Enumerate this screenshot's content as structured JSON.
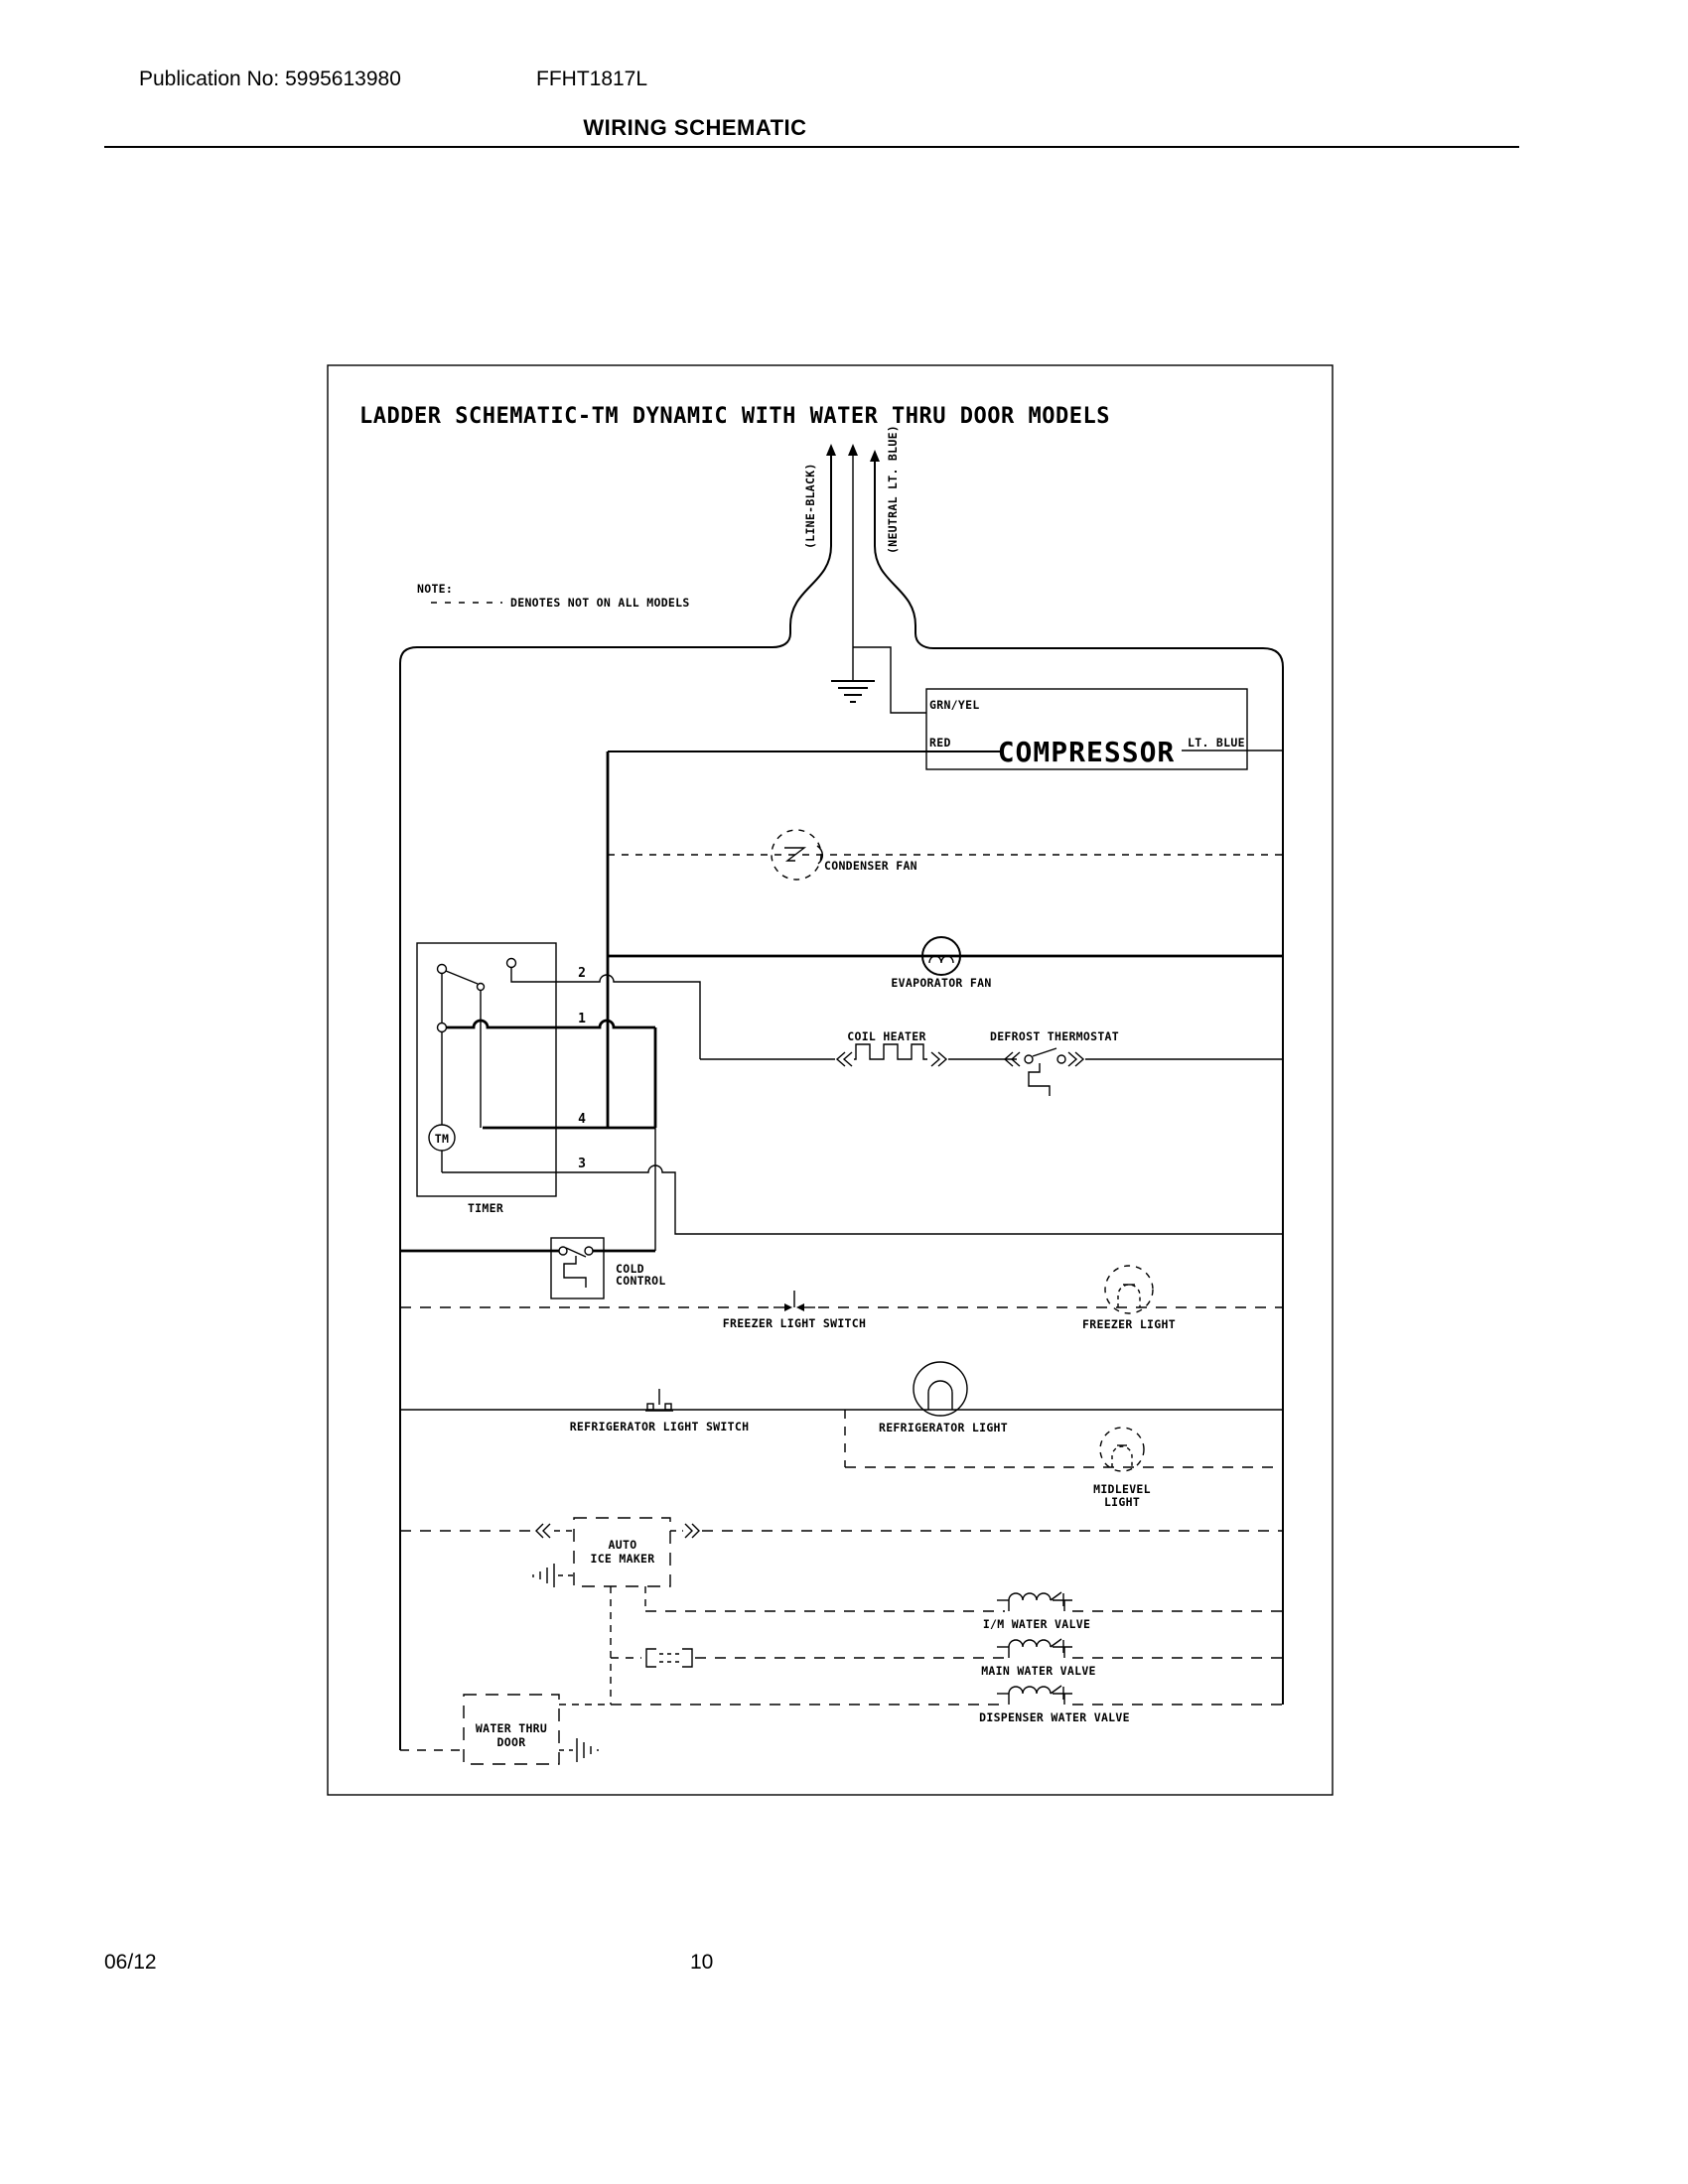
{
  "page": {
    "publication": "Publication No: 5995613980",
    "model": "FFHT1817L",
    "section_title": "WIRING SCHEMATIC",
    "footer_date": "06/12",
    "footer_page": "10"
  },
  "schematic": {
    "title": "LADDER SCHEMATIC-TM DYNAMIC WITH WATER THRU DOOR MODELS",
    "note": {
      "label": "NOTE:",
      "text": "DENOTES NOT ON ALL MODELS"
    },
    "supply": {
      "line_label": "(LINE-BLACK)",
      "neutral_label": "(NEUTRAL LT. BLUE)"
    },
    "compressor": {
      "name": "COMPRESSOR",
      "top_wire": "GRN/YEL",
      "left_wire": "RED",
      "right_wire": "LT. BLUE"
    },
    "components": {
      "condenser_fan": "CONDENSER FAN",
      "evaporator_fan": "EVAPORATOR FAN",
      "coil_heater": "COIL HEATER",
      "defrost_thermostat": "DEFROST THERMOSTAT",
      "cold_control_line1": "COLD",
      "cold_control_line2": "CONTROL",
      "freezer_light_switch": "FREEZER LIGHT SWITCH",
      "freezer_light": "FREEZER LIGHT",
      "refrigerator_light_switch": "REFRIGERATOR LIGHT SWITCH",
      "refrigerator_light": "REFRIGERATOR LIGHT",
      "midlevel_light_line1": "MIDLEVEL",
      "midlevel_light_line2": "LIGHT",
      "auto_ice_maker_line1": "AUTO",
      "auto_ice_maker_line2": "ICE MAKER",
      "im_water_valve": "I/M WATER VALVE",
      "main_water_valve": "MAIN WATER VALVE",
      "dispenser_water_valve": "DISPENSER WATER VALVE",
      "water_thru_door_line1": "WATER THRU",
      "water_thru_door_line2": "DOOR"
    },
    "timer": {
      "label": "TIMER",
      "motor_label": "TM",
      "terminals": [
        "2",
        "1",
        "4",
        "3"
      ]
    }
  }
}
